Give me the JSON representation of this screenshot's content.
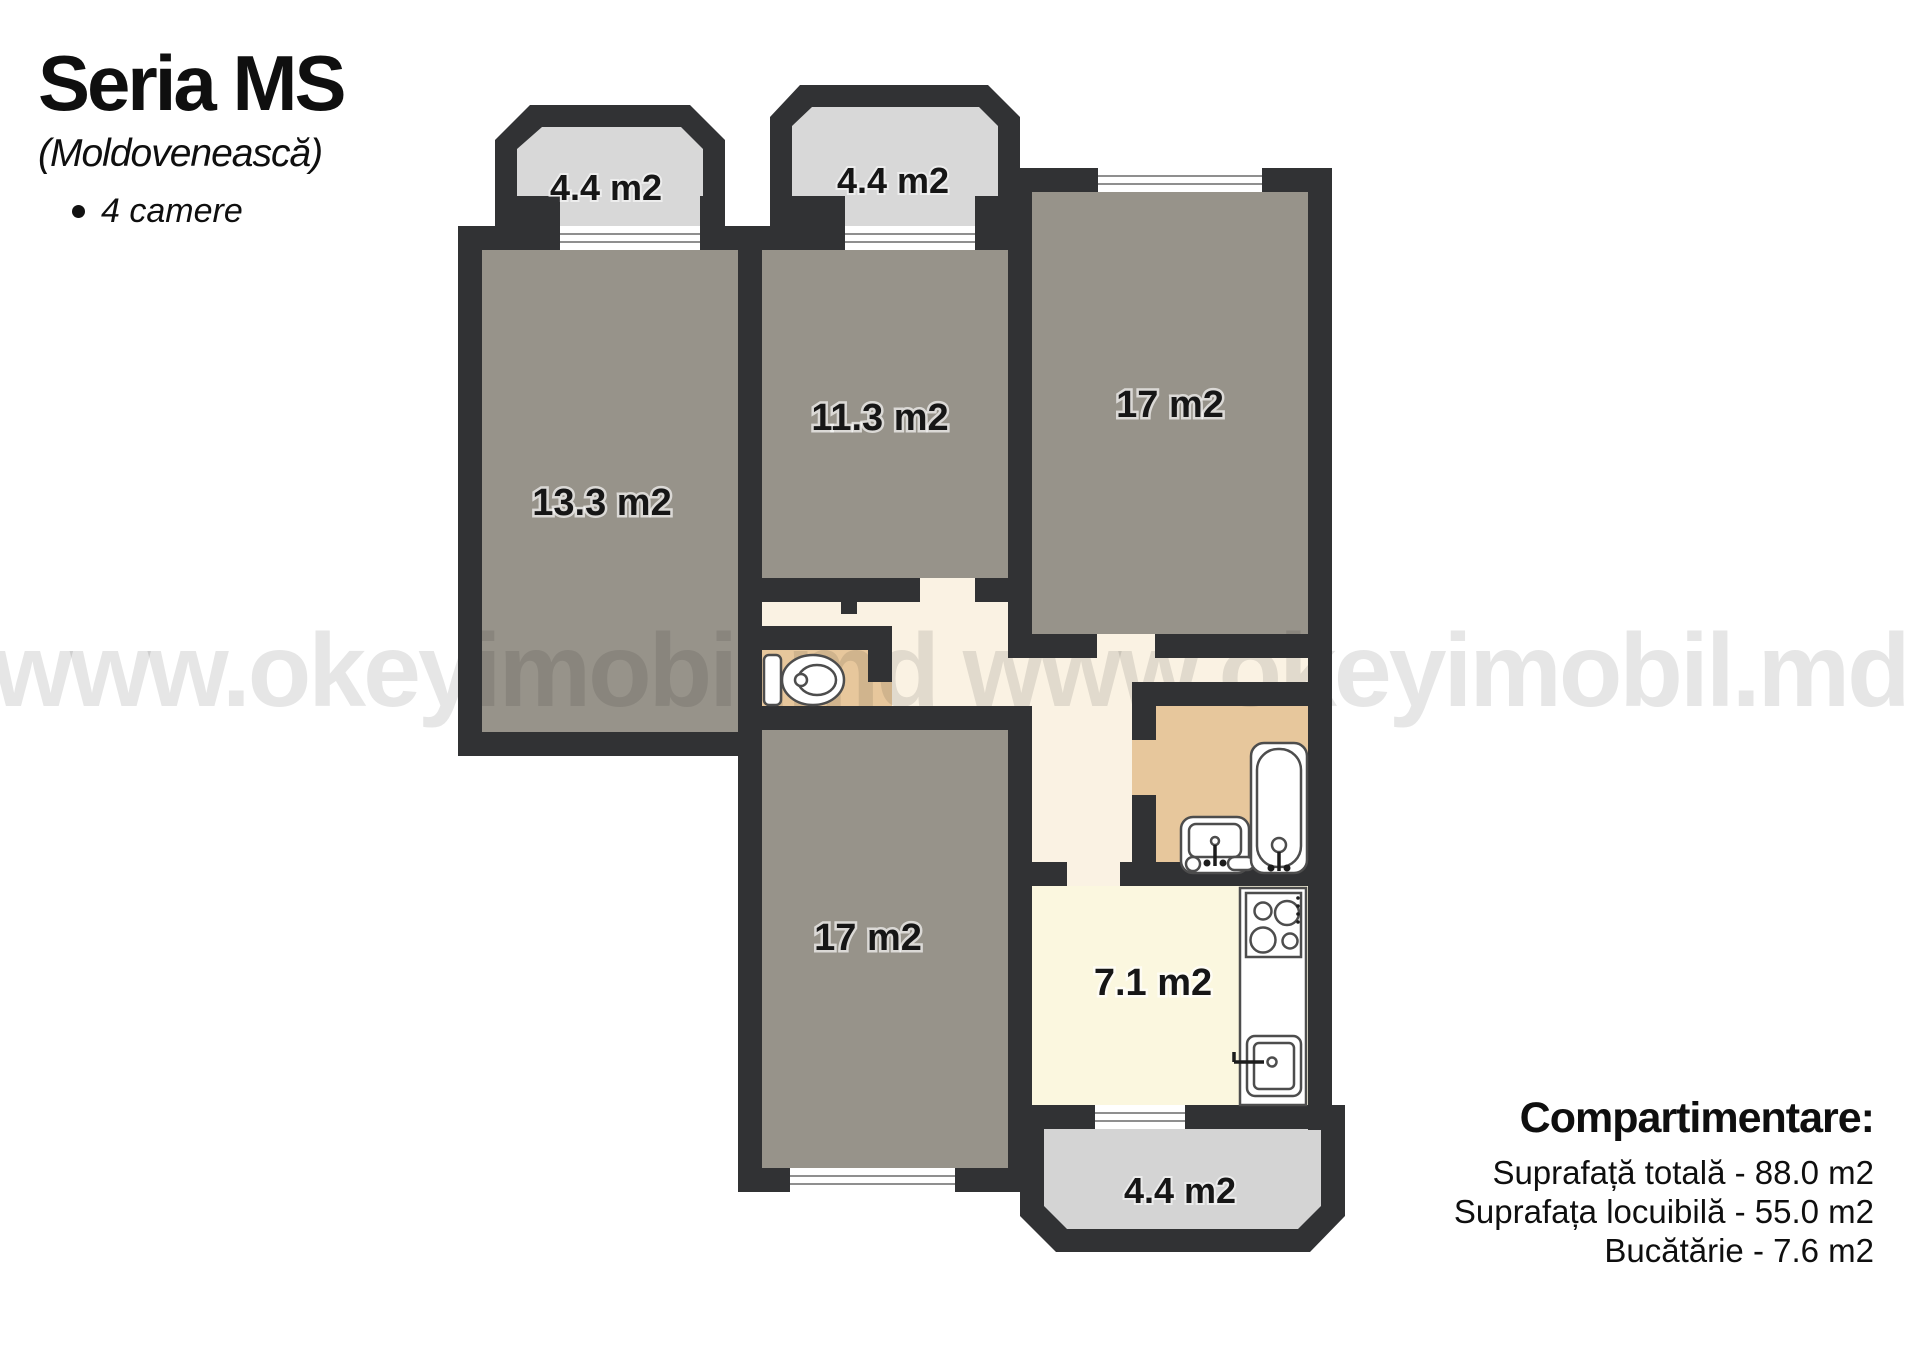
{
  "header": {
    "series_title": "Seria MS",
    "series_subtitle": "(Moldovenească)",
    "bullet_item": "4 camere"
  },
  "watermark": {
    "text": "www.okeyimobil.md www.okeyimobil.md"
  },
  "plan": {
    "rooms": [
      {
        "name": "room-13-3",
        "label": "13.3 m2"
      },
      {
        "name": "room-11-3",
        "label": "11.3 m2"
      },
      {
        "name": "room-17-top",
        "label": "17 m2"
      },
      {
        "name": "room-17-bottom",
        "label": "17 m2"
      },
      {
        "name": "kitchen",
        "label": "7.1 m2"
      }
    ],
    "balconies": [
      {
        "name": "balcony-top-left",
        "label": "4.4 m2"
      },
      {
        "name": "balcony-top-middle",
        "label": "4.4 m2"
      },
      {
        "name": "balcony-bottom",
        "label": "4.4 m2"
      }
    ],
    "fixtures": [
      "toilet",
      "bath-sink",
      "bathtub",
      "stove",
      "kitchen-sink"
    ]
  },
  "summary": {
    "title": "Compartimentare:",
    "lines": [
      "Suprafață totală - 88.0 m2",
      "Suprafața locuibilă - 55.0 m2",
      "Bucătărie - 7.6 m2"
    ]
  },
  "palette": {
    "wall": "#313234",
    "room_fill": "#97938a",
    "hallway_fill": "#faf2e3",
    "wet_room_fill": "#e7c79c",
    "kitchen_fill": "#fbf7df",
    "balcony_fill": "#d8d8d8",
    "watermark_gray": "#e3e3e3",
    "label_color": "#161616"
  }
}
